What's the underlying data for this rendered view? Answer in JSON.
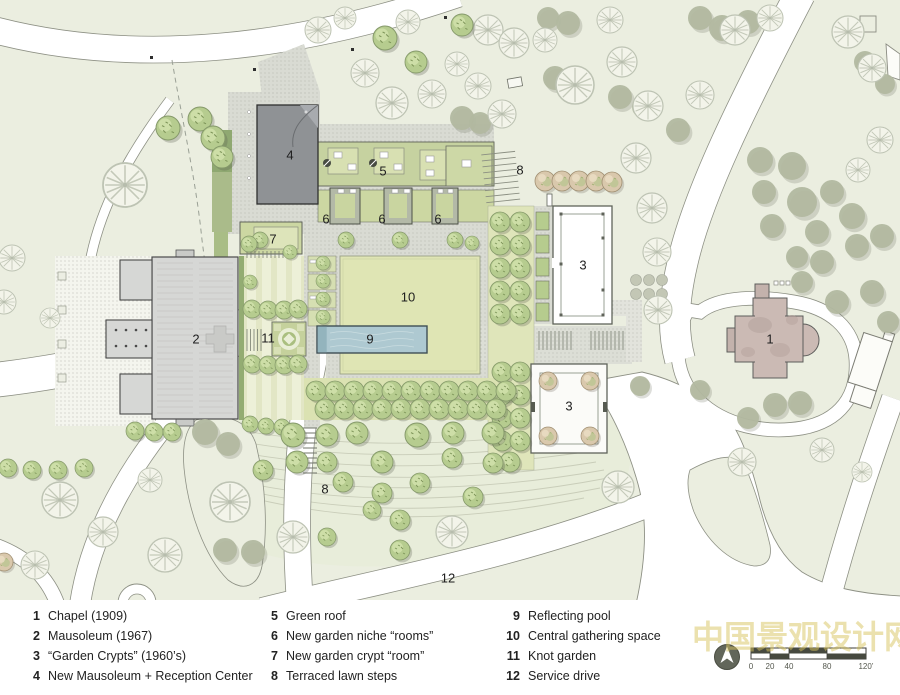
{
  "plan": {
    "markers": {
      "1": "1",
      "2": "2",
      "3": "3",
      "4": "4",
      "5": "5",
      "6": "6",
      "7": "7",
      "8": "8",
      "9": "9",
      "10": "10",
      "11": "11",
      "12": "12"
    }
  },
  "legend": {
    "columns": [
      {
        "items": [
          {
            "num": "1",
            "label": "Chapel (1909)"
          },
          {
            "num": "2",
            "label": "Mausoleum (1967)"
          },
          {
            "num": "3",
            "label": "“Garden Crypts” (1960’s)"
          },
          {
            "num": "4",
            "label": "New Mausoleum + Reception Center"
          }
        ]
      },
      {
        "items": [
          {
            "num": "5",
            "label": "Green roof"
          },
          {
            "num": "6",
            "label": "New garden niche “rooms”"
          },
          {
            "num": "7",
            "label": "New garden crypt “room”"
          },
          {
            "num": "8",
            "label": "Terraced lawn steps"
          }
        ]
      },
      {
        "items": [
          {
            "num": "9",
            "label": "Reflecting pool"
          },
          {
            "num": "10",
            "label": "Central gathering space"
          },
          {
            "num": "11",
            "label": "Knot garden"
          },
          {
            "num": "12",
            "label": "Service drive"
          }
        ]
      }
    ]
  },
  "scale_bar": {
    "ticks": [
      "0",
      "20",
      "40",
      "80",
      "120’"
    ]
  },
  "watermark": {
    "text": "中国景观设计网"
  },
  "colors": {
    "background": "#ebeee0",
    "road": "#ffffff",
    "paving": "#d9dbd3",
    "lawn": "#dfe5b4",
    "green_roof": "#c6d2a0",
    "pool": "#aec9d1",
    "building_gray": "#8f9295",
    "mausoleum": "#d6d7d5",
    "chapel_pink": "#cbbab4",
    "tree_green": "#b6cc8f",
    "watermark_yellow": "#d8c45f"
  }
}
